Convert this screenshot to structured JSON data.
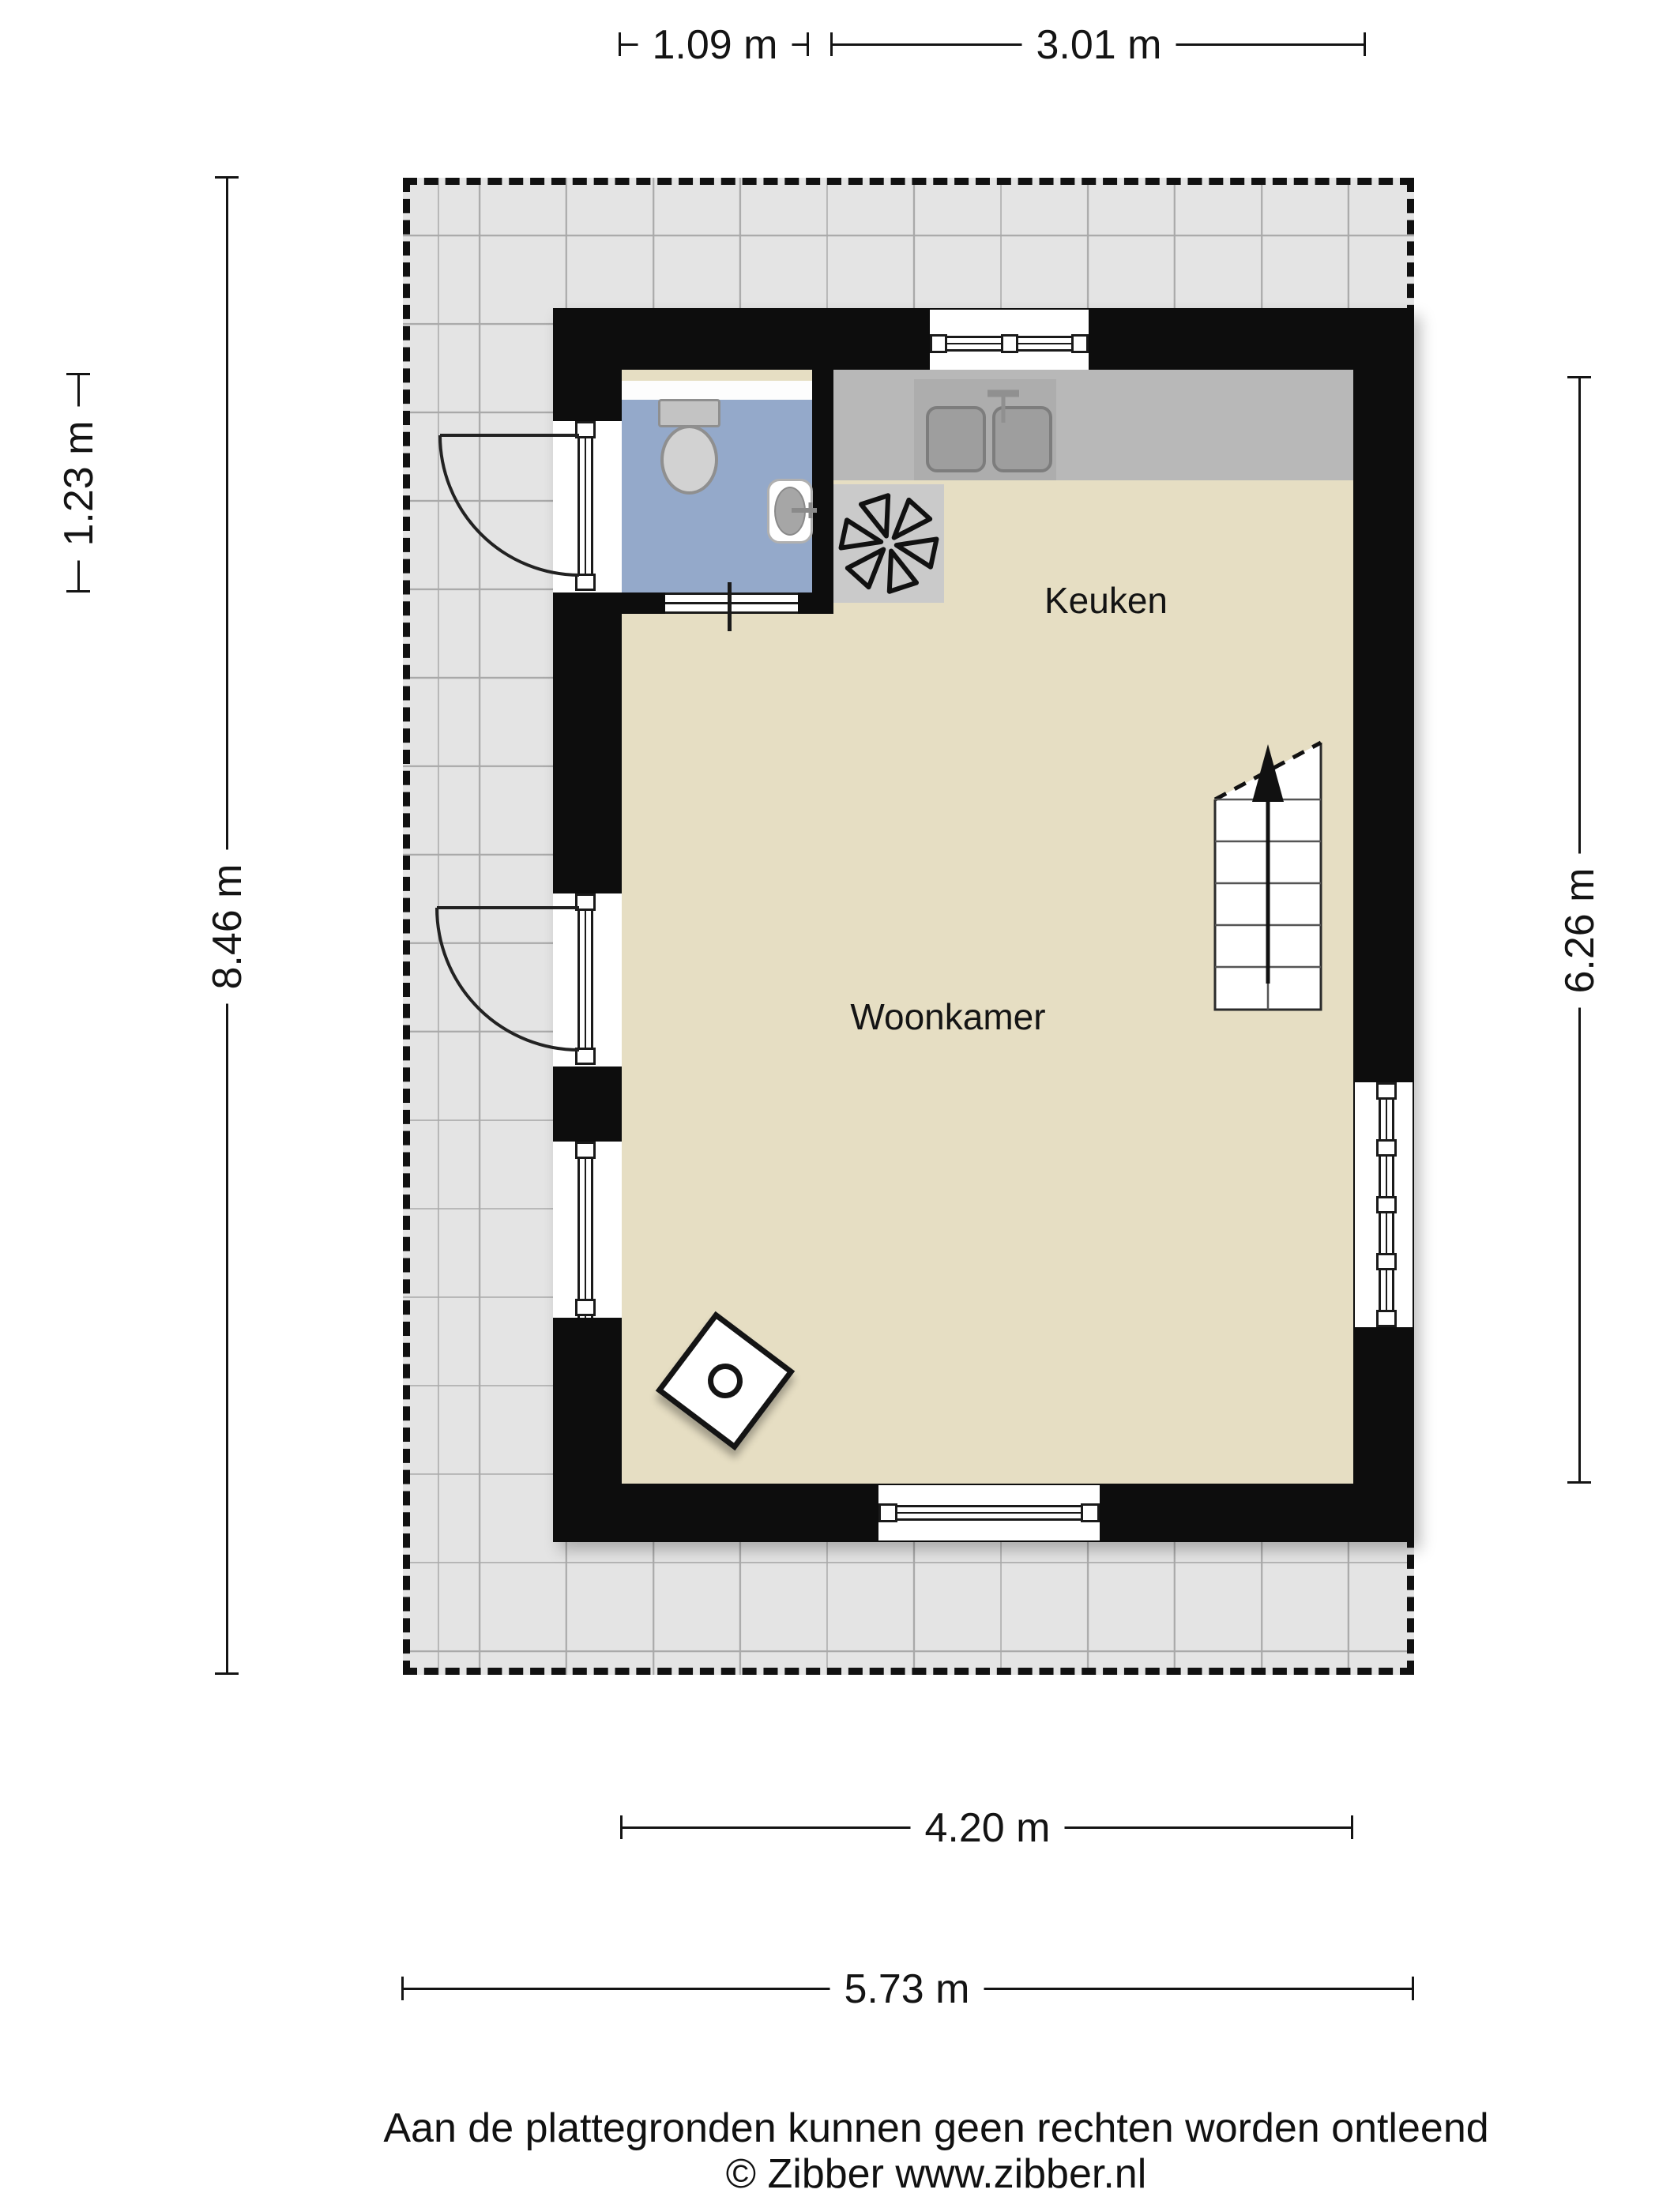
{
  "plan": {
    "rooms": [
      {
        "id": "keuken",
        "label": "Keuken"
      },
      {
        "id": "woonkamer",
        "label": "Woonkamer"
      }
    ],
    "dimensions": {
      "top_toilet_width": "1.09 m",
      "top_kitchen_width": "3.01 m",
      "left_toilet_depth": "1.23 m",
      "left_total_height": "8.46 m",
      "right_interior_height": "6.26 m",
      "bottom_interior_width": "4.20 m",
      "bottom_total_width": "5.73 m"
    },
    "colors": {
      "wall": "#0d0d0d",
      "floor": "#e6dec3",
      "toilet_floor": "#94a9ca",
      "kitchen_counter": "#b8b8b8",
      "terrace": "#e4e4e4"
    },
    "icons": {
      "fan": "ventilation-fan",
      "stairs_arrow": "stairs-up-arrow",
      "stove": "wood-stove",
      "toilet": "toilet-top-view",
      "basin": "hand-basin",
      "kitchen_sink": "double-sink"
    }
  },
  "footer": {
    "disclaimer": "Aan de plattegronden kunnen geen rechten worden ontleend",
    "copyright": "© Zibber www.zibber.nl"
  }
}
